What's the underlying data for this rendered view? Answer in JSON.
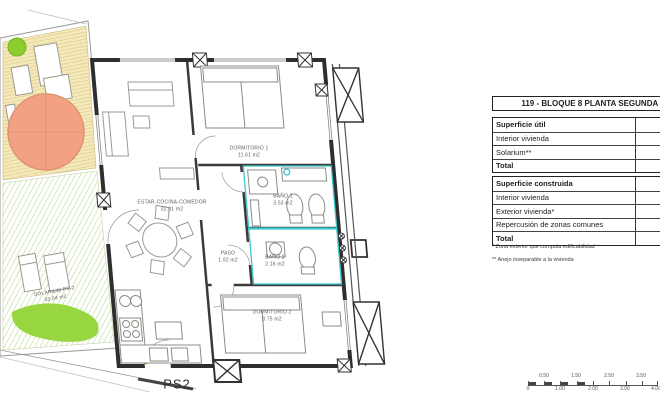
{
  "plan": {
    "drawing_label": "PS2",
    "rooms": [
      {
        "name": "DORMITORIO 1",
        "area": "11.61 m2"
      },
      {
        "name": "ESTAR-COCINA-COMEDOR",
        "area": "32.01 m2"
      },
      {
        "name": "BAÑO 1",
        "area": "3.53 m2"
      },
      {
        "name": "PASO",
        "area": "1.92 m2"
      },
      {
        "name": "BAÑO 2",
        "area": "2.16 m2"
      },
      {
        "name": "DORMITORIO 2",
        "area": "8.75 m2"
      },
      {
        "name": "SOLARIUM PS-2",
        "area": "33.04 m2"
      }
    ],
    "scale_bar": {
      "below": [
        "0",
        "1.00",
        "2.00",
        "3.00",
        "4.00"
      ],
      "above": [
        "0.50",
        "1.50",
        "2.50",
        "3.50"
      ]
    }
  },
  "panel": {
    "title": "119 - BLOQUE 8 PLANTA SEGUNDA 2",
    "superficie_util": {
      "header": "Superficie útil",
      "rows": [
        "Interior vivienda",
        "Solarium**",
        "Total"
      ]
    },
    "superficie_construida": {
      "header": "Superficie construida",
      "rows": [
        "Interior vivienda",
        "Exterior vivienda*",
        "Repercusión de zonas comunes",
        "Total"
      ]
    },
    "footnotes": [
      "* Zona exterior que computa edificabilidad",
      "** Anejo inseparable a la vivienda"
    ]
  },
  "colors": {
    "wall": "#2e2e2e",
    "tile_teal": "#3bc7cb",
    "terrace_hatch_yellow": "#d9c06a",
    "solarium_hatch_green": "#a8cf72",
    "lawn_green": "#8fd431",
    "plant_green": "#8ccd2d",
    "parasol_orange": "#f2a183"
  }
}
